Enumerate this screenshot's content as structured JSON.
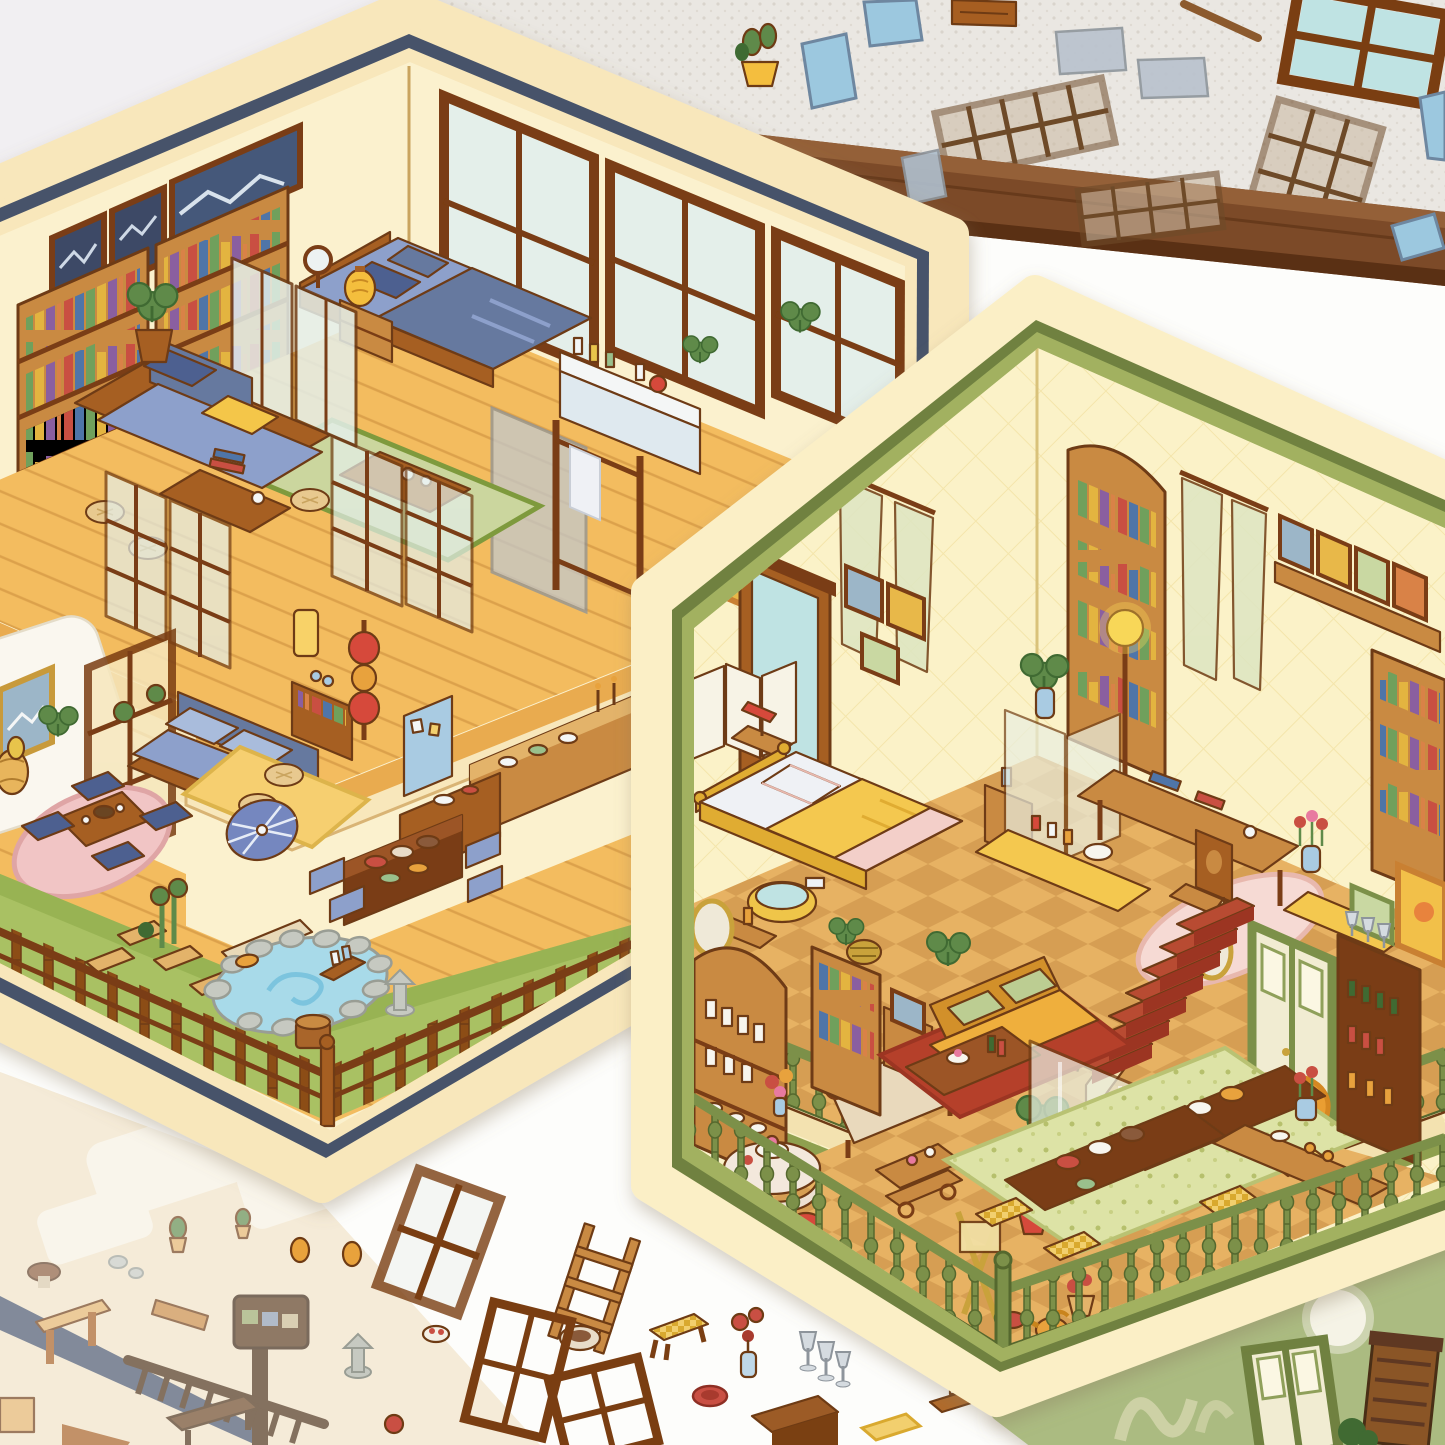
{
  "palette": {
    "ink": "#6E3B14",
    "bgTop": "#F1EFF2",
    "bgWhite": "#FDFDFB",
    "fabric": "#EAE7E2",
    "fabricDot": "#D9D4CC",
    "beam": "#7C4A28",
    "beamDark": "#5A3014",
    "beamHi": "#946038",
    "cream": "#F8E7BB",
    "creamEdge": "#E6CD96",
    "navy": "#47536B",
    "wall": "#FBF1CE",
    "woodDark": "#7A3E12",
    "wood": "#A65E21",
    "woodLight": "#C98A43",
    "woodPale": "#E3B36B",
    "glass": "#E4EFEA",
    "glassTeal": "#BFE3E3",
    "glassGray": "#C2C8CC",
    "floorWood": "#F3BC5F",
    "floorLine": "#DCA14B",
    "floorEdge": "#E9AB4F",
    "tatami": "#CBD69E",
    "matGreen": "#A9C163",
    "matSide": "#8FAC4B",
    "matEdge": "#7E9A3E",
    "pond": "#A8DAE9",
    "pondSwirl": "#7CC4DE",
    "rock": "#C6C9C1",
    "rockDark": "#999D94",
    "pinkRug": "#F1C5C5",
    "pinkEdge": "#DFA5A5",
    "sofaBlue": "#8DA0CB",
    "sofaBlueDk": "#66799F",
    "pillowNavy": "#4D6190",
    "pillowYellow": "#F4C64A",
    "bedWhite": "#EFF1F5",
    "lanternY": "#F4BE3E",
    "lanternRed": "#D6493B",
    "fridgeBlue": "#A9CBE2",
    "umbrella": "#7487BF",
    "cream2": "#FBEFC6",
    "olive": "#6F8140",
    "oliveLight": "#A2B161",
    "wall2": "#FBF2C8",
    "tile": "#E7B264",
    "tileDk": "#D69E52",
    "railGreen": "#7C9048",
    "railDark": "#55682D",
    "stairRed": "#B84B31",
    "stairSide": "#F3E2B0",
    "carpetRed": "#B5402C",
    "carpetDk": "#9C3523",
    "sofaGold": "#EFAF3D",
    "sofaGoldDk": "#D2902B",
    "pillowGreen": "#BCCD92",
    "bedGold": "#F4C84F",
    "bedGoldDk": "#E0AC32",
    "bedPink": "#F3CFC9",
    "rugOrange": "#EA9E33",
    "rugOrangeDk": "#D68822",
    "rugFloral": "#DDE3A6",
    "screenGlass": "#E9EEE0",
    "sage": "#ABBB81",
    "sageDark": "#96A76B",
    "cabinet": "#8A5526",
    "pinkSoft": "#F6DAD4",
    "green": "#5F8A4A",
    "greenDk": "#3F6B33",
    "red": "#C94F43",
    "blue": "#4F74A8",
    "paper": "#F7F3E6"
  },
  "scene": {
    "setting": "craft table with layered isometric dollhouse sticker sheets",
    "surfaces": [
      "white tabletop",
      "linen fabric cloth",
      "dark wooden beam"
    ],
    "sheets": [
      {
        "name": "japanese-loft-sheet",
        "shape": "hexagonal",
        "border": [
          "cream",
          "navy-blue"
        ],
        "upper_floor_items": [
          "bookcases with books",
          "framed pictures",
          "blue fabric sofa",
          "yellow cushion",
          "potted plant",
          "low wooden table",
          "floor poufs",
          "blue double bed",
          "bedside cabinet",
          "paper lantern lamp",
          "round mirror",
          "tatami rug",
          "tea table",
          "folding glass partitions",
          "wooden lattice screens",
          "bathroom vanity with bottles",
          "glass shower panel",
          "wooden towel rack",
          "large paned windows"
        ],
        "lower_floor_items": [
          "white armchair",
          "gold framed picture",
          "rattan lamp",
          "tall window door",
          "blue loveseat sofa",
          "book shelf",
          "glowing lamp",
          "red lantern totem lamp",
          "honeycomb rug",
          "floor poufs",
          "blue pinboard fridge",
          "kitchen counter with dishes",
          "candlesticks",
          "dining table with food trays",
          "blue bench cushions",
          "pink round rug",
          "low tea table",
          "floor cushions",
          "blue paper umbrella",
          "grass porch mat",
          "stepping stones",
          "wooden bench",
          "bamboo plant",
          "rock hot-spring pond",
          "wooden barrel",
          "stone lantern",
          "wooden fence railing"
        ]
      },
      {
        "name": "vintage-manor-sheet",
        "shape": "hexagonal",
        "border": [
          "cream",
          "olive-green"
        ],
        "upper_floor_items": [
          "sunflower painting",
          "wooden wardrobe",
          "sheer green curtains",
          "small framed pictures",
          "arched bookcase",
          "picture shelf",
          "tall bookcase",
          "yellow bed with lace pillow",
          "folding screen",
          "translucent divider",
          "nightstand with blue bottle",
          "red table lamp",
          "monstera plants",
          "glowing floor lamp",
          "writing desk with books",
          "carved chair",
          "vanity with perfume bottles",
          "white cat figure",
          "tulip vase",
          "bench",
          "pink rug",
          "checkered tile floor",
          "green balustrade railing",
          "bath basin with towels",
          "woven basket",
          "fruit bowl table",
          "red book"
        ],
        "lower_floor_items": [
          "arched display shelf with milk bottles",
          "round dessert table",
          "red stools",
          "wooden chaise",
          "flower bouquet",
          "yellow bookcase",
          "picture cabinet",
          "tufted yellow sofa",
          "green pillows",
          "coffee table with cake and wine",
          "red carpet",
          "monstera plant",
          "standing glass screen",
          "dessert trolley",
          "wooden easel",
          "red staircase with runner",
          "gold oval mirrors",
          "green double door",
          "sunset painting",
          "wine cabinet",
          "drinks console",
          "tulip vases",
          "orange medallion rug",
          "floral green rug",
          "dining tables with roast dinner",
          "checkered stools",
          "watering can",
          "flower pots",
          "buckets",
          "green balustrade railing"
        ]
      },
      {
        "name": "faded-practice-sheet",
        "items": [
          "navy stripe",
          "wooden bench",
          "sign post",
          "garden rake fence",
          "planks",
          "mushroom",
          "stones",
          "cactus pots",
          "ghost furniture outlines"
        ]
      },
      {
        "name": "sage-green-sheet",
        "items": [
          "green door frame",
          "wooden cabinet",
          "full moon sticker",
          "faded printed lettering",
          "leafy bush"
        ]
      }
    ],
    "loose_stickers": [
      "blue glass panes",
      "gray glass panes",
      "lattice window grids",
      "four-pane windows",
      "potted plant",
      "wooden stick",
      "drawer box",
      "ladder",
      "checkered stool",
      "flower vase",
      "wine glasses",
      "red plate",
      "side table",
      "serving tray",
      "stone lantern",
      "pears",
      "window frames",
      "food plate",
      "red bowl",
      "yellow mat",
      "blue checkered cushion"
    ]
  }
}
